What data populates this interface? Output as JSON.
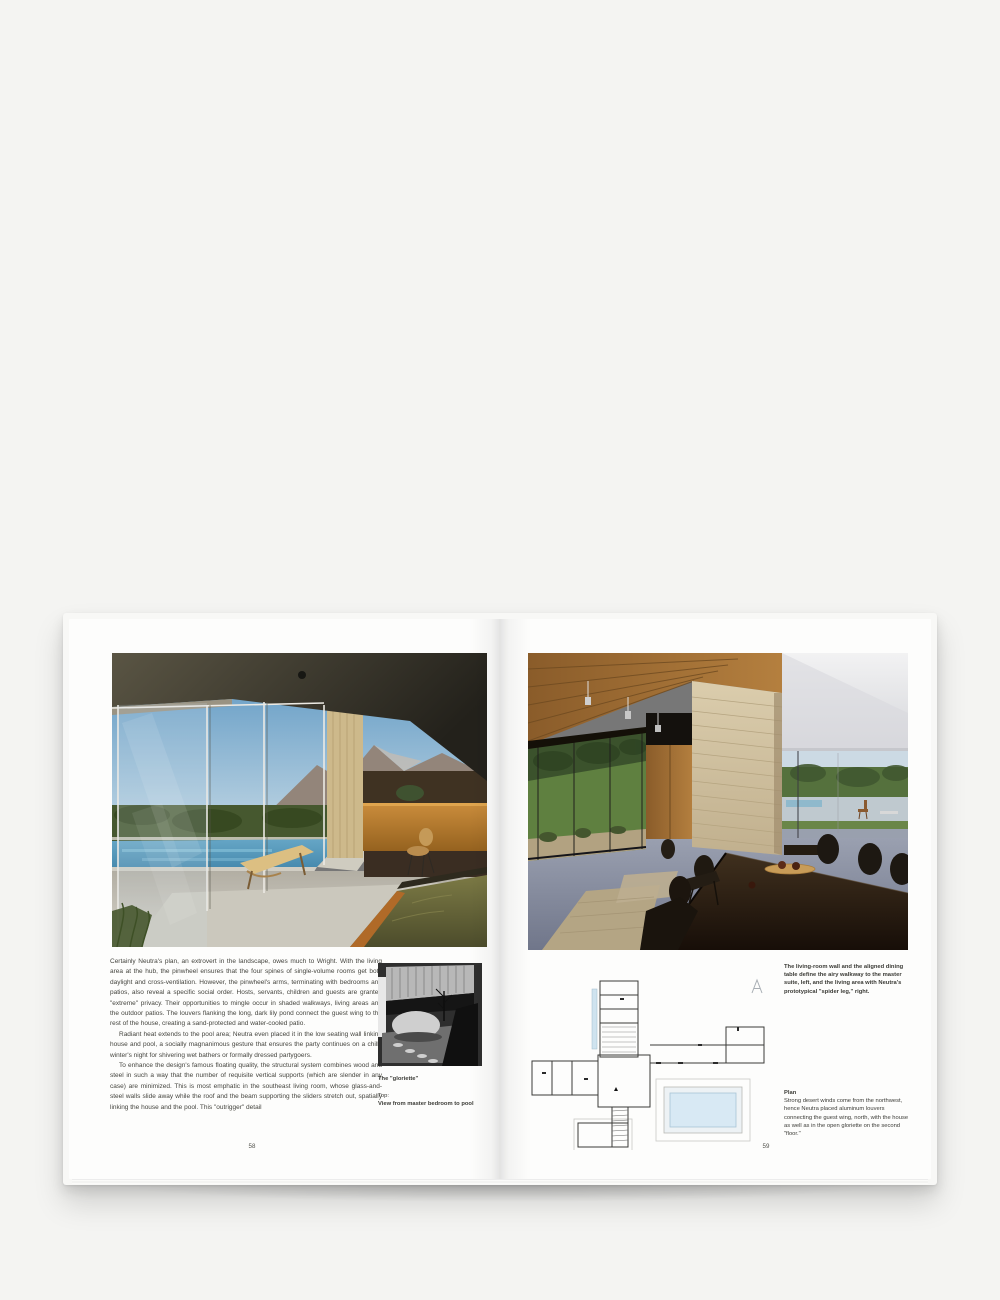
{
  "meta": {
    "description": "Photograph of an open architecture book spread (Neutra, Kaufmann House), pages 58-59",
    "colors": {
      "background": "#f4f4f2",
      "page": "#fdfdfc",
      "ink": "#45453f",
      "pool_blue": "#d8e9f4",
      "plan_line": "#3a3a38"
    }
  },
  "book": {
    "left_page": {
      "page_number": "58",
      "photo_alt": "Living area with glass walls sliding open to the pool, chaise longue, desk and mountains beyond",
      "body_paragraphs": [
        "Certainly Neutra's plan, an extrovert in the landscape, owes much to Wright. With the living area at the hub, the pinwheel ensures that the four spines of single-volume rooms get both daylight and cross-ventilation. However, the pinwheel's arms, terminating with bedrooms and patios, also reveal a specific social order. Hosts, servants, children and guests are granted \"extreme\" privacy. Their opportunities to mingle occur in shaded walkways, living areas and the outdoor patios. The louvers flanking the long, dark lily pond connect the guest wing to the rest of the house, creating a sand-protected and water-cooled patio.",
        "Radiant heat extends to the pool area; Neutra even placed it in the low seating wall linking house and pool, a socially magnanimous gesture that ensures the party continues on a chilly winter's night for shivering wet bathers or formally dressed partygoers.",
        "To enhance the design's famous floating quality, the structural system combines wood and steel in such a way that the number of requisite vertical supports (which are slender in any case) are minimized. This is most emphatic in the southeast living room, whose glass-and-steel walls slide away while the roof and the beam supporting the sliders stretch out, spatially linking the house and the pool. This \"outrigger\" detail"
      ],
      "bw_photo_alt": "The gloriette: boulder, small tree and louvered canopy (black and white)",
      "caption_title": "The \"gloriette\"",
      "caption_label": "Top:",
      "caption_bold": "View from master bedroom to pool"
    },
    "right_page": {
      "page_number": "59",
      "photo_alt": "Dining table and sandstone pillar between the living-room wall and the walkway to the master suite",
      "caption_top": "The living-room wall and the aligned dining table define the airy walkway to the master suite, left, and the living area with Neutra's prototypical \"spider leg,\" right.",
      "plan_alt": "Pinwheel floor plan with guest wing, lily pond, pool and gloriette stair",
      "plan_caption_title": "Plan",
      "plan_caption_body": "Strong desert winds come from the northwest, hence Neutra placed aluminum louvers connecting the guest wing, north, with the house as well as in the open gloriette on the second \"floor.\""
    }
  }
}
